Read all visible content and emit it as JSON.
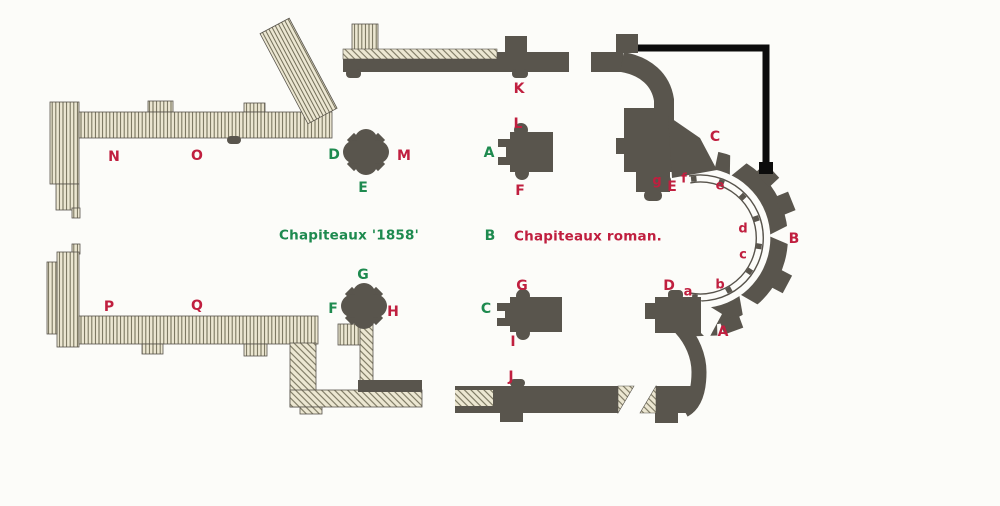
{
  "colors": {
    "green_capitals": "#1e8a4f",
    "red_capitals": "#c01f3f",
    "dark_walls": "#59554d",
    "hatched_wall_fill": "#ece7d2",
    "hatch_line": "#6e6a54",
    "background": "#fcfcf9",
    "annotation_line": "#0c0c0c"
  },
  "labels": [
    {
      "text": "N",
      "color": "red"
    },
    {
      "text": "O",
      "color": "red"
    },
    {
      "text": "D",
      "color": "green"
    },
    {
      "text": "M",
      "color": "red"
    },
    {
      "text": "E",
      "color": "green"
    },
    {
      "text": "K",
      "color": "red"
    },
    {
      "text": "L",
      "color": "red"
    },
    {
      "text": "A",
      "color": "green"
    },
    {
      "text": "F",
      "color": "red"
    },
    {
      "text": "Chapiteaux '1858'",
      "color": "green"
    },
    {
      "text": "B",
      "color": "green"
    },
    {
      "text": "Chapiteaux roman.",
      "color": "red"
    },
    {
      "text": "P",
      "color": "red"
    },
    {
      "text": "Q",
      "color": "red"
    },
    {
      "text": "G",
      "color": "green"
    },
    {
      "text": "F",
      "color": "green"
    },
    {
      "text": "H",
      "color": "red"
    },
    {
      "text": "G",
      "color": "red"
    },
    {
      "text": "C",
      "color": "green"
    },
    {
      "text": "I",
      "color": "red"
    },
    {
      "text": "J",
      "color": "red"
    },
    {
      "text": "C",
      "color": "red"
    },
    {
      "text": "g",
      "color": "red"
    },
    {
      "text": "E",
      "color": "red"
    },
    {
      "text": "f",
      "color": "red"
    },
    {
      "text": "e",
      "color": "red"
    },
    {
      "text": "d",
      "color": "red"
    },
    {
      "text": "c",
      "color": "red"
    },
    {
      "text": "b",
      "color": "red"
    },
    {
      "text": "a",
      "color": "red"
    },
    {
      "text": "D",
      "color": "red"
    },
    {
      "text": "A",
      "color": "red"
    },
    {
      "text": "B",
      "color": "red"
    }
  ]
}
